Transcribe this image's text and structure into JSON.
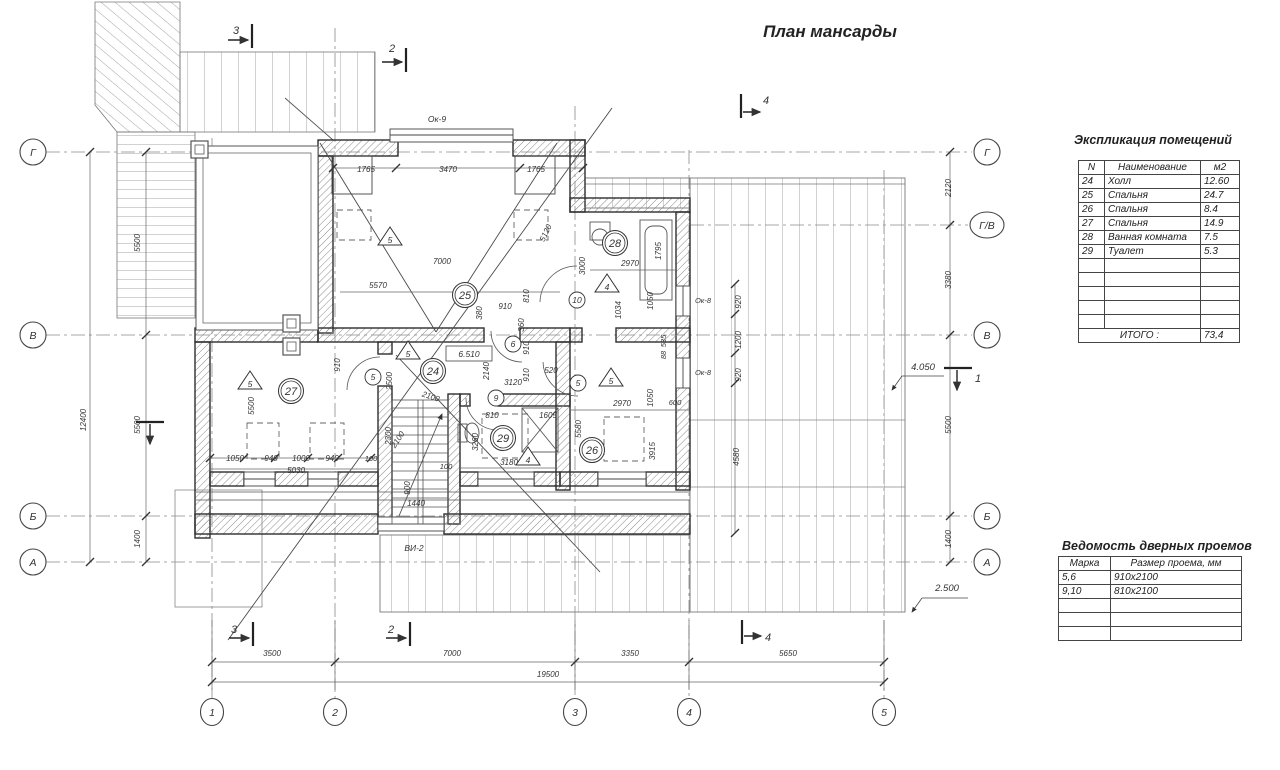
{
  "title": "План мансарды",
  "tables": {
    "rooms": {
      "title": "Экспликация помещений",
      "headers": [
        "N",
        "Наименование",
        "м2"
      ],
      "rows": [
        [
          "24",
          "Холл",
          "12.60"
        ],
        [
          "25",
          "Спальня",
          "24.7"
        ],
        [
          "26",
          "Спальня",
          "8.4"
        ],
        [
          "27",
          "Спальня",
          "14.9"
        ],
        [
          "28",
          "Ванная комната",
          "7.5"
        ],
        [
          "29",
          "Туалет",
          "5.3"
        ]
      ],
      "empty_rows": 5,
      "total_label": "ИТОГО   :",
      "total_value": "73,4"
    },
    "doors": {
      "title": "Ведомость дверных проемов",
      "headers": [
        "Марка",
        "Размер проема, мм"
      ],
      "rows": [
        [
          "5,6",
          "910х2100"
        ],
        [
          "9,10",
          "810х2100"
        ]
      ],
      "empty_rows": 3
    }
  },
  "axis_circles": {
    "left": [
      {
        "label": "Г",
        "y": 152
      },
      {
        "label": "В",
        "y": 335
      },
      {
        "label": "Б",
        "y": 516
      },
      {
        "label": "А",
        "y": 562
      }
    ],
    "right": [
      {
        "label": "Г",
        "y": 152
      },
      {
        "label": "Г/В",
        "y": 225
      },
      {
        "label": "В",
        "y": 335
      },
      {
        "label": "Б",
        "y": 516
      },
      {
        "label": "А",
        "y": 562
      }
    ],
    "bottom": [
      {
        "label": "1",
        "x": 212
      },
      {
        "label": "2",
        "x": 335
      },
      {
        "label": "3",
        "x": 575
      },
      {
        "label": "4",
        "x": 689
      },
      {
        "label": "5",
        "x": 884
      }
    ]
  },
  "room_circles": [
    {
      "n": "24",
      "x": 433,
      "y": 371
    },
    {
      "n": "25",
      "x": 465,
      "y": 295
    },
    {
      "n": "26",
      "x": 592,
      "y": 450
    },
    {
      "n": "27",
      "x": 291,
      "y": 391
    },
    {
      "n": "28",
      "x": 615,
      "y": 243
    },
    {
      "n": "29",
      "x": 503,
      "y": 438
    }
  ],
  "door_circles": [
    {
      "n": "5",
      "x": 373,
      "y": 377
    },
    {
      "n": "5",
      "x": 578,
      "y": 383
    },
    {
      "n": "6",
      "x": 513,
      "y": 344
    },
    {
      "n": "9",
      "x": 496,
      "y": 398
    },
    {
      "n": "10",
      "x": 577,
      "y": 300
    }
  ],
  "door_triangles": [
    {
      "n": "5",
      "x": 390,
      "y": 237
    },
    {
      "n": "4",
      "x": 607,
      "y": 284
    },
    {
      "n": "5",
      "x": 408,
      "y": 351
    },
    {
      "n": "5",
      "x": 250,
      "y": 381
    },
    {
      "n": "5",
      "x": 611,
      "y": 378
    },
    {
      "n": "4",
      "x": 528,
      "y": 457
    }
  ],
  "labels": [
    {
      "t": "3",
      "x": 236,
      "y": 34,
      "s": 11
    },
    {
      "t": "2",
      "x": 392,
      "y": 52,
      "s": 11
    },
    {
      "t": "4",
      "x": 766,
      "y": 104,
      "s": 11
    },
    {
      "t": "3",
      "x": 234,
      "y": 633,
      "s": 11
    },
    {
      "t": "2",
      "x": 391,
      "y": 633,
      "s": 11
    },
    {
      "t": "4",
      "x": 768,
      "y": 641,
      "s": 11
    },
    {
      "t": "1",
      "x": 978,
      "y": 382,
      "s": 11
    },
    {
      "t": "4.050",
      "x": 923,
      "y": 370,
      "s": 9.5
    },
    {
      "t": "2.500",
      "x": 947,
      "y": 591,
      "s": 9.5
    },
    {
      "t": "6.510",
      "x": 469,
      "y": 357,
      "s": 8.5
    },
    {
      "t": "Ок-9",
      "x": 437,
      "y": 122,
      "s": 8.5
    },
    {
      "t": "Ок-8",
      "x": 703,
      "y": 303,
      "s": 7.5
    },
    {
      "t": "Ок-8",
      "x": 703,
      "y": 375,
      "s": 7.5
    },
    {
      "t": "ВИ-2",
      "x": 414,
      "y": 551,
      "s": 8.5
    },
    {
      "t": "5500",
      "x": 140,
      "y": 243,
      "r": -90
    },
    {
      "t": "5500",
      "x": 140,
      "y": 425,
      "r": -90
    },
    {
      "t": "1400",
      "x": 140,
      "y": 539,
      "r": -90
    },
    {
      "t": "12400",
      "x": 86,
      "y": 420,
      "r": -90
    },
    {
      "t": "2120",
      "x": 951,
      "y": 188,
      "r": -90
    },
    {
      "t": "3380",
      "x": 951,
      "y": 280,
      "r": -90
    },
    {
      "t": "5500",
      "x": 951,
      "y": 425,
      "r": -90
    },
    {
      "t": "1400",
      "x": 951,
      "y": 539,
      "r": -90
    },
    {
      "t": "3500",
      "x": 272,
      "y": 656
    },
    {
      "t": "7000",
      "x": 452,
      "y": 656
    },
    {
      "t": "3350",
      "x": 630,
      "y": 656
    },
    {
      "t": "5650",
      "x": 788,
      "y": 656
    },
    {
      "t": "19500",
      "x": 548,
      "y": 677
    },
    {
      "t": "1765",
      "x": 366,
      "y": 172
    },
    {
      "t": "3470",
      "x": 448,
      "y": 172
    },
    {
      "t": "1765",
      "x": 536,
      "y": 172
    },
    {
      "t": "5120",
      "x": 548,
      "y": 234,
      "r": -65
    },
    {
      "t": "7000",
      "x": 442,
      "y": 264
    },
    {
      "t": "5570",
      "x": 378,
      "y": 288
    },
    {
      "t": "910",
      "x": 505,
      "y": 309
    },
    {
      "t": "810",
      "x": 529,
      "y": 296,
      "r": -90
    },
    {
      "t": "380",
      "x": 482,
      "y": 313,
      "r": -90
    },
    {
      "t": "360",
      "x": 524,
      "y": 325,
      "r": -90
    },
    {
      "t": "910",
      "x": 529,
      "y": 348,
      "r": -90
    },
    {
      "t": "910",
      "x": 529,
      "y": 375,
      "r": -90
    },
    {
      "t": "520",
      "x": 551,
      "y": 373
    },
    {
      "t": "3000",
      "x": 585,
      "y": 266,
      "r": -90
    },
    {
      "t": "2970",
      "x": 630,
      "y": 266
    },
    {
      "t": "1795",
      "x": 661,
      "y": 251,
      "r": -90
    },
    {
      "t": "1050",
      "x": 653,
      "y": 301,
      "r": -90
    },
    {
      "t": "1034",
      "x": 621,
      "y": 310,
      "r": -90
    },
    {
      "t": "920",
      "x": 741,
      "y": 302,
      "r": -90
    },
    {
      "t": "1200",
      "x": 741,
      "y": 340,
      "r": -90
    },
    {
      "t": "920",
      "x": 741,
      "y": 375,
      "r": -90
    },
    {
      "t": "4580",
      "x": 739,
      "y": 457,
      "r": -90
    },
    {
      "t": "535",
      "x": 666,
      "y": 341,
      "r": -90,
      "s": 7.5
    },
    {
      "t": "88",
      "x": 666,
      "y": 355,
      "r": -90,
      "s": 7.5
    },
    {
      "t": "2140",
      "x": 489,
      "y": 371,
      "r": -90
    },
    {
      "t": "3120",
      "x": 513,
      "y": 385
    },
    {
      "t": "1050",
      "x": 653,
      "y": 398,
      "r": -90
    },
    {
      "t": "2970",
      "x": 622,
      "y": 406
    },
    {
      "t": "600",
      "x": 675,
      "y": 405,
      "s": 7.5
    },
    {
      "t": "5580",
      "x": 581,
      "y": 429,
      "r": -90
    },
    {
      "t": "3915",
      "x": 655,
      "y": 451,
      "r": -90
    },
    {
      "t": "810",
      "x": 492,
      "y": 418
    },
    {
      "t": "1605",
      "x": 548,
      "y": 418
    },
    {
      "t": "3260",
      "x": 478,
      "y": 442,
      "r": -90
    },
    {
      "t": "3180",
      "x": 509,
      "y": 465
    },
    {
      "t": "100",
      "x": 446,
      "y": 469,
      "s": 7.5
    },
    {
      "t": "2100",
      "x": 430,
      "y": 399,
      "r": 18
    },
    {
      "t": "2100",
      "x": 400,
      "y": 441,
      "r": -57
    },
    {
      "t": "2300",
      "x": 391,
      "y": 436,
      "r": -90
    },
    {
      "t": "900",
      "x": 410,
      "y": 488,
      "r": -90
    },
    {
      "t": "1440",
      "x": 416,
      "y": 506
    },
    {
      "t": "5500",
      "x": 254,
      "y": 406,
      "r": -90
    },
    {
      "t": "910",
      "x": 340,
      "y": 365,
      "r": -90
    },
    {
      "t": "2500",
      "x": 392,
      "y": 381,
      "r": -90
    },
    {
      "t": "1050",
      "x": 235,
      "y": 461
    },
    {
      "t": "940",
      "x": 271,
      "y": 461
    },
    {
      "t": "1000",
      "x": 301,
      "y": 461
    },
    {
      "t": "940",
      "x": 332,
      "y": 461
    },
    {
      "t": "100",
      "x": 371,
      "y": 461,
      "s": 7.5
    },
    {
      "t": "5030",
      "x": 296,
      "y": 473
    }
  ]
}
